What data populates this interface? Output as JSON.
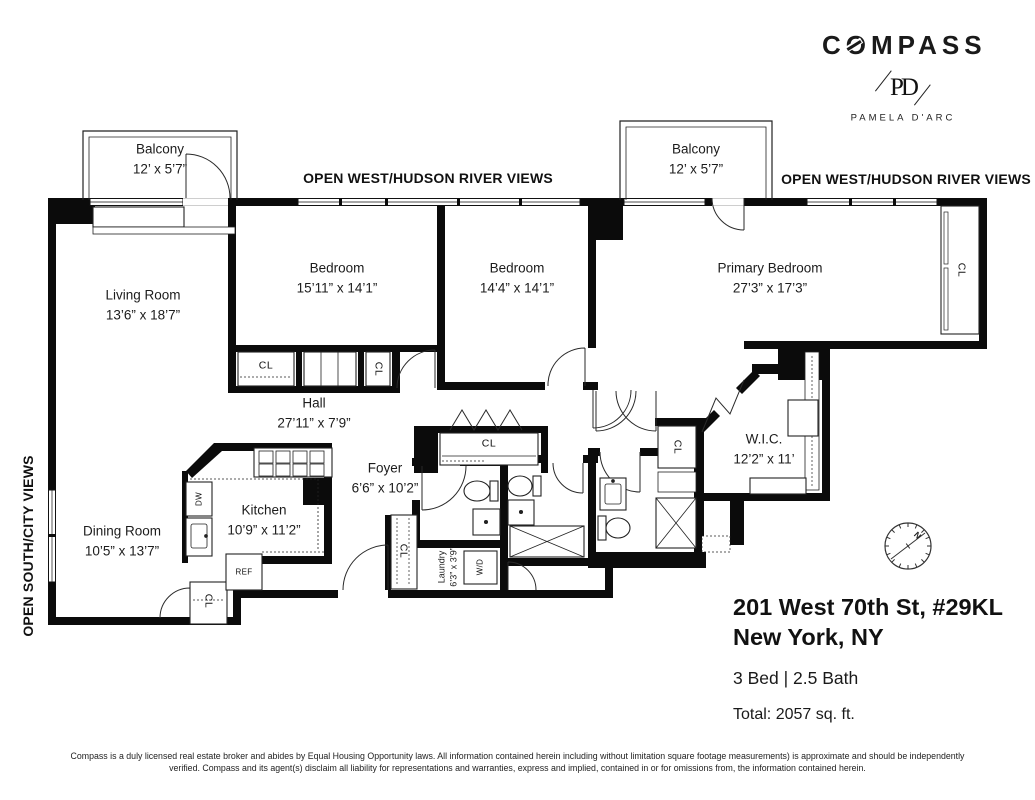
{
  "brand": {
    "logo": "COMPASS",
    "monogram": "PD",
    "agent": "PAMELA D'ARC"
  },
  "views": {
    "west_left": "OPEN WEST/HUDSON RIVER VIEWS",
    "west_right": "OPEN WEST/HUDSON RIVER VIEWS",
    "south": "OPEN SOUTH/CITY VIEWS"
  },
  "rooms": [
    {
      "id": "living-room",
      "name": "Living Room",
      "dims": "13’6” x 18’7”"
    },
    {
      "id": "bedroom-1",
      "name": "Bedroom",
      "dims": "15’11” x 14’1”"
    },
    {
      "id": "bedroom-2",
      "name": "Bedroom",
      "dims": "14’4” x 14’1”"
    },
    {
      "id": "primary-bedroom",
      "name": "Primary Bedroom",
      "dims": "27’3” x 17’3”"
    },
    {
      "id": "balcony-left",
      "name": "Balcony",
      "dims": "12’ x 5’7”"
    },
    {
      "id": "balcony-right",
      "name": "Balcony",
      "dims": "12’ x 5’7”"
    },
    {
      "id": "hall",
      "name": "Hall",
      "dims": "27’11” x 7’9”"
    },
    {
      "id": "foyer",
      "name": "Foyer",
      "dims": "6’6” x 10’2”"
    },
    {
      "id": "kitchen",
      "name": "Kitchen",
      "dims": "10’9” x 11’2”"
    },
    {
      "id": "dining-room",
      "name": "Dining Room",
      "dims": "10’5” x 13’7”"
    },
    {
      "id": "wic",
      "name": "W.I.C.",
      "dims": "12’2” x 11’"
    },
    {
      "id": "laundry",
      "name": "Laundry",
      "dims": "6’3” x 3’9”"
    }
  ],
  "fixtures": {
    "closet": "CL",
    "fridge": "REF",
    "dishwasher": "DW",
    "washer_dryer": "W/D"
  },
  "compass_rose": {
    "north": "N"
  },
  "listing": {
    "address_line1": "201 West 70th St, #29KL",
    "address_line2": "New York, NY",
    "beds_baths": "3 Bed | 2.5 Bath",
    "total": "Total: 2057 sq. ft."
  },
  "disclaimer": {
    "line1": "Compass is a duly licensed real estate broker and abides by Equal Housing Opportunity laws. All information contained herein including without limitation square footage measurements) is approximate and should be independently",
    "line2": "verified. Compass and its agent(s) disclaim all liability for representations and warranties, express and implied, contained in or for omissions from, the information contained herein."
  }
}
